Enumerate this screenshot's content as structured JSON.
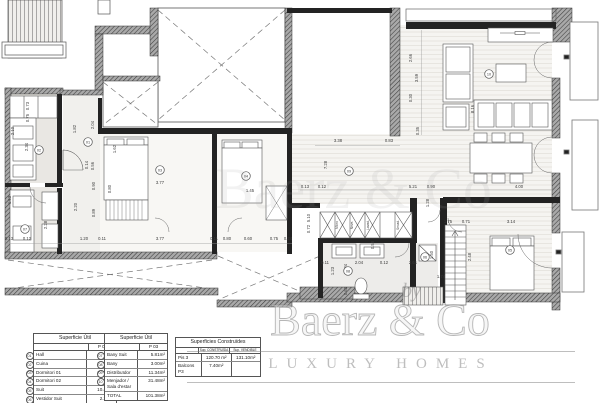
{
  "watermark": {
    "by": "by",
    "brand": "Baerz & Co",
    "tagline": "LUXURY HOMES"
  },
  "tables": {
    "util1": {
      "title": "Superficie Útil",
      "col": "P 03",
      "rows": [
        {
          "ref": "01",
          "label": "Hall",
          "value": "2.84m²"
        },
        {
          "ref": "02",
          "label": "Cuina",
          "value": "17.30m²"
        },
        {
          "ref": "03",
          "label": "Dormitori 01",
          "value": "12.53m²"
        },
        {
          "ref": "04",
          "label": "Dormitori 02",
          "value": "7.86m²"
        },
        {
          "ref": "05",
          "label": "Suit",
          "value": "10.43m²"
        },
        {
          "ref": "06",
          "label": "Vestidor Suit",
          "value": "2.25m²"
        }
      ]
    },
    "util2": {
      "title": "Superficie Útil",
      "col": "P 03",
      "rows": [
        {
          "ref": "07",
          "label": "Bany Suit",
          "value": "5.81m²"
        },
        {
          "ref": "08",
          "label": "Bany",
          "value": "3.00m²"
        },
        {
          "ref": "09",
          "label": "Distribuïdor",
          "value": "11.34m²"
        },
        {
          "ref": "10",
          "label": "Menjador / Sala d'estar",
          "value": "31.48m²"
        },
        {
          "ref": "",
          "label": "TOTAL",
          "value": "101.38m²"
        }
      ]
    },
    "built": {
      "title": "Superficies Construïdes",
      "cols": [
        "Sup. CONSTRUÏDA",
        "Sup. VENDIBLE"
      ],
      "rows": [
        {
          "label": "Pis 3",
          "c1": "120.70 m²",
          "c2": "131.10m²"
        },
        {
          "label": "Balcons P3",
          "c1": "7.40m²",
          "c2": ""
        }
      ]
    }
  },
  "plan": {
    "dims": [
      {
        "t": "3.38",
        "x": 338,
        "y": 142
      },
      {
        "t": "0.83",
        "x": 389,
        "y": 142
      },
      {
        "t": "0.13",
        "x": 305,
        "y": 188
      },
      {
        "t": "0.12",
        "x": 322,
        "y": 188
      },
      {
        "t": "5.21",
        "x": 413,
        "y": 188
      },
      {
        "t": "0.90",
        "x": 431,
        "y": 188
      },
      {
        "t": "4.00",
        "x": 519,
        "y": 188
      },
      {
        "t": "7.28",
        "x": 327,
        "y": 165,
        "v": 1
      },
      {
        "t": "2.66",
        "x": 412,
        "y": 58,
        "v": 1
      },
      {
        "t": "3.59",
        "x": 418,
        "y": 78,
        "v": 1
      },
      {
        "t": "0.30",
        "x": 412,
        "y": 98,
        "v": 1
      },
      {
        "t": "0.35",
        "x": 419,
        "y": 131,
        "v": 1
      },
      {
        "t": "8.16",
        "x": 474,
        "y": 109,
        "v": 1
      },
      {
        "t": "3.77",
        "x": 160,
        "y": 184
      },
      {
        "t": "1.45",
        "x": 250,
        "y": 192
      },
      {
        "t": "0.13",
        "x": 9,
        "y": 240
      },
      {
        "t": "0.12",
        "x": 27,
        "y": 240
      },
      {
        "t": "1.20",
        "x": 84,
        "y": 240
      },
      {
        "t": "0.11",
        "x": 102,
        "y": 240
      },
      {
        "t": "3.77",
        "x": 160,
        "y": 240
      },
      {
        "t": "0.11",
        "x": 214,
        "y": 240
      },
      {
        "t": "0.80",
        "x": 227,
        "y": 240
      },
      {
        "t": "0.60",
        "x": 248,
        "y": 240
      },
      {
        "t": "0.75",
        "x": 274,
        "y": 240
      },
      {
        "t": "0.24",
        "x": 288,
        "y": 240
      },
      {
        "t": "2.20",
        "x": 77,
        "y": 207,
        "v": 1
      },
      {
        "t": "0.90",
        "x": 95,
        "y": 186,
        "v": 1
      },
      {
        "t": "0.89",
        "x": 95,
        "y": 213,
        "v": 1
      },
      {
        "t": "0.80",
        "x": 111,
        "y": 189,
        "v": 1
      },
      {
        "t": "1.62",
        "x": 116,
        "y": 149,
        "v": 1
      },
      {
        "t": "1.82",
        "x": 76,
        "y": 129,
        "v": 1
      },
      {
        "t": "2.04",
        "x": 94,
        "y": 125,
        "v": 1
      },
      {
        "t": "0.14",
        "x": 88,
        "y": 165,
        "v": 1
      },
      {
        "t": "0.56",
        "x": 94,
        "y": 166,
        "v": 1
      },
      {
        "t": "0.73",
        "x": 29,
        "y": 106,
        "v": 1
      },
      {
        "t": "0.75",
        "x": 29,
        "y": 118,
        "v": 1
      },
      {
        "t": "2.34",
        "x": 28,
        "y": 147,
        "v": 1
      },
      {
        "t": "1.53",
        "x": 11,
        "y": 200,
        "v": 1
      },
      {
        "t": "2.28",
        "x": 47,
        "y": 225,
        "v": 1
      },
      {
        "t": "2.10",
        "x": 14,
        "y": 131,
        "v": 1
      },
      {
        "t": "5.10",
        "x": 310,
        "y": 218,
        "v": 1
      },
      {
        "t": "0.72",
        "x": 310,
        "y": 229,
        "v": 1
      },
      {
        "t": "1.75",
        "x": 448,
        "y": 223
      },
      {
        "t": "0.71",
        "x": 466,
        "y": 223
      },
      {
        "t": "3.14",
        "x": 511,
        "y": 223
      },
      {
        "t": "1.28",
        "x": 429,
        "y": 203,
        "v": 1
      },
      {
        "t": "1.50",
        "x": 433,
        "y": 255,
        "v": 1
      },
      {
        "t": "2.48",
        "x": 471,
        "y": 257,
        "v": 1
      },
      {
        "t": "0.11",
        "x": 325,
        "y": 264
      },
      {
        "t": "2.04",
        "x": 359,
        "y": 264
      },
      {
        "t": "0.12",
        "x": 384,
        "y": 264
      },
      {
        "t": "2.61",
        "x": 413,
        "y": 264
      },
      {
        "t": "1.74",
        "x": 441,
        "y": 278
      },
      {
        "t": "1.23",
        "x": 334,
        "y": 271,
        "v": 1
      },
      {
        "t": "5.84",
        "x": 347,
        "y": 268,
        "v": 1
      },
      {
        "t": "0.58",
        "x": 374,
        "y": 245,
        "v": 1
      },
      {
        "t": "0.62",
        "x": 347,
        "y": 291,
        "v": 1
      }
    ],
    "bubbles": [
      {
        "n": "01",
        "x": 88,
        "y": 142
      },
      {
        "n": "02",
        "x": 39,
        "y": 150
      },
      {
        "n": "03",
        "x": 160,
        "y": 170
      },
      {
        "n": "04",
        "x": 246,
        "y": 176
      },
      {
        "n": "05",
        "x": 510,
        "y": 250
      },
      {
        "n": "06",
        "x": 425,
        "y": 257
      },
      {
        "n": "07",
        "x": 25,
        "y": 229
      },
      {
        "n": "08",
        "x": 348,
        "y": 271
      },
      {
        "n": "09",
        "x": 349,
        "y": 171
      },
      {
        "n": "10",
        "x": 489,
        "y": 74
      }
    ],
    "closet_labels": [
      {
        "t": "Micro",
        "x": 338,
        "y": 225
      },
      {
        "t": "Neve.",
        "x": 353,
        "y": 225
      },
      {
        "t": "Lavad.",
        "x": 369,
        "y": 225
      },
      {
        "t": "Secad.",
        "x": 399,
        "y": 225
      }
    ]
  },
  "colors": {
    "wall": "#2e2e2e",
    "hatch": "#9c9c9c",
    "line": "#555555",
    "watermark": "#b5b5b5"
  }
}
